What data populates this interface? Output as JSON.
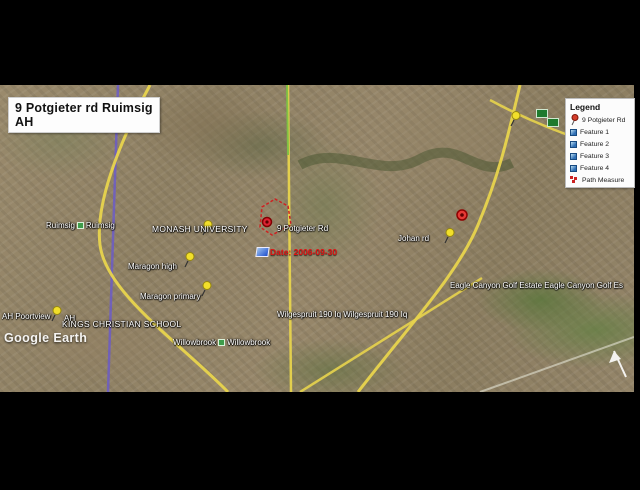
{
  "title": "9 Potgieter rd Ruimsig AH",
  "legend": {
    "title": "Legend",
    "items": [
      {
        "label": "9 Potgieter Rd",
        "icon": "red-pushpin"
      },
      {
        "label": "Feature 1",
        "icon": "blue-square"
      },
      {
        "label": "Feature 2",
        "icon": "blue-square"
      },
      {
        "label": "Feature 3",
        "icon": "blue-square"
      },
      {
        "label": "Feature 4",
        "icon": "blue-square"
      },
      {
        "label": "Path Measure",
        "icon": "red-path-dots"
      }
    ]
  },
  "map_labels": {
    "ruimsig_a": "Ruimsig",
    "ruimsig_b": "Ruimsig",
    "monash": "MONASH UNIVERSITY",
    "potgieter": "9 Potgieter Rd",
    "date": "Date: 2006-09-30",
    "maragon_high": "Maragon high",
    "maragon_primary": "Maragon primary",
    "poortview_a": "AH Poortview",
    "poortview_b": "AH",
    "kings": "KINGS CHRISTIAN SCHOOL",
    "willowbrook_a": "Willowbrook",
    "willowbrook_b": "Willowbrook",
    "wilgespruit": "Wilgespruit 190 Iq Wilgespruit 190 Iq",
    "johan": "Johan rd",
    "eagle": "Eagle Canyon Golf Estate Eagle Canyon Golf Es"
  },
  "watermark": "Google Earth",
  "colors": {
    "pushpin_yellow": "#f2df2a",
    "placemark_red": "#b71c1c",
    "road_yellow": "#e8d44d",
    "road_purple": "#6a5acd",
    "path_measure_red": "#cc2222",
    "legend_blue": "#2f6fb5"
  }
}
